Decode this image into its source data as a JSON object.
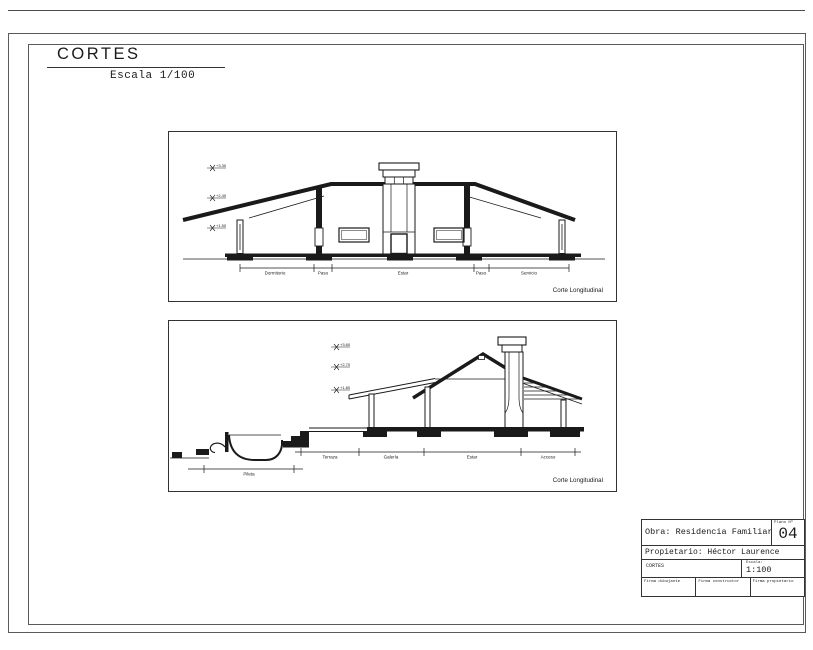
{
  "sheet": {
    "title": "CORTES",
    "scale_note": "Escala 1/100"
  },
  "drawing1": {
    "caption": "Corte Longitudinal",
    "rooms": [
      "Dormitorio",
      "Paso",
      "Estar",
      "Paso",
      "Servicio"
    ],
    "levels": [
      "+3.30",
      "+2.40",
      "+1.50"
    ]
  },
  "drawing2": {
    "caption": "Corte Longitudinal",
    "rooms": [
      "Terraza",
      "Galería",
      "Estar",
      "Acceso"
    ],
    "pool_label": "Pileta",
    "levels": [
      "+3.60",
      "+2.70",
      "+1.80"
    ]
  },
  "title_block": {
    "obra": "Obra: Residencia Familiar",
    "plano_label": "Plano Nº",
    "plano_number": "04",
    "propietario": "Propietario: Héctor Laurence",
    "doc_name": "CORTES",
    "escala_label": "Escala:",
    "escala_value": "1:100",
    "firmas": [
      "Firma dibujante",
      "Firma constructor",
      "Firma propietario"
    ]
  },
  "colors": {
    "ink": "#1a1a1a",
    "frame": "#5a5a5a"
  }
}
